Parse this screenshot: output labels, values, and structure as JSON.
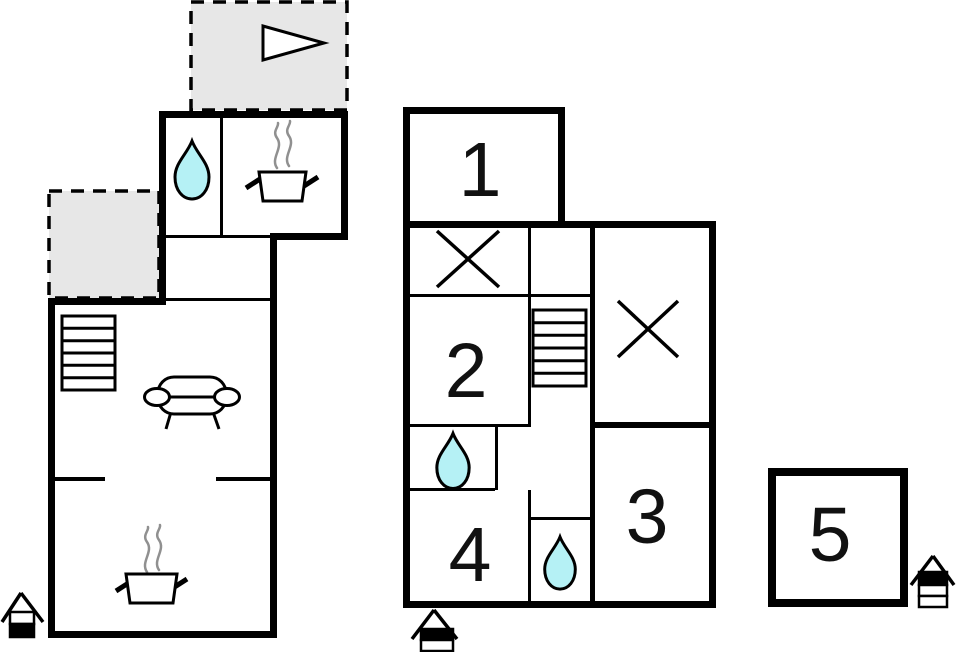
{
  "floorplan": {
    "kind": "property floor plan",
    "rooms": [
      {
        "label": "1"
      },
      {
        "label": "2"
      },
      {
        "label": "3"
      },
      {
        "label": "4"
      },
      {
        "label": "5"
      }
    ],
    "icons": [
      {
        "name": "direction-arrow-icon",
        "meaning": "arrow on terrace"
      },
      {
        "name": "water-drop-icon",
        "meaning": "bathroom / water",
        "count": 3
      },
      {
        "name": "cooking-pot-icon",
        "meaning": "kitchen / stove",
        "count": 2
      },
      {
        "name": "sofa-icon",
        "meaning": "living room seating"
      },
      {
        "name": "staircase-icon",
        "meaning": "stairs",
        "count": 2
      },
      {
        "name": "cross-marker-icon",
        "meaning": "crossed-out area",
        "count": 2
      },
      {
        "name": "house-entrance-icon",
        "meaning": "floor level indicator",
        "count": 3
      }
    ],
    "colors": {
      "wall": "#000000",
      "background": "#ffffff",
      "terrace_fill": "#e7e7e7",
      "water_drop": "#b5f1f5",
      "steam": "#909090",
      "label_text": "#111111"
    }
  }
}
